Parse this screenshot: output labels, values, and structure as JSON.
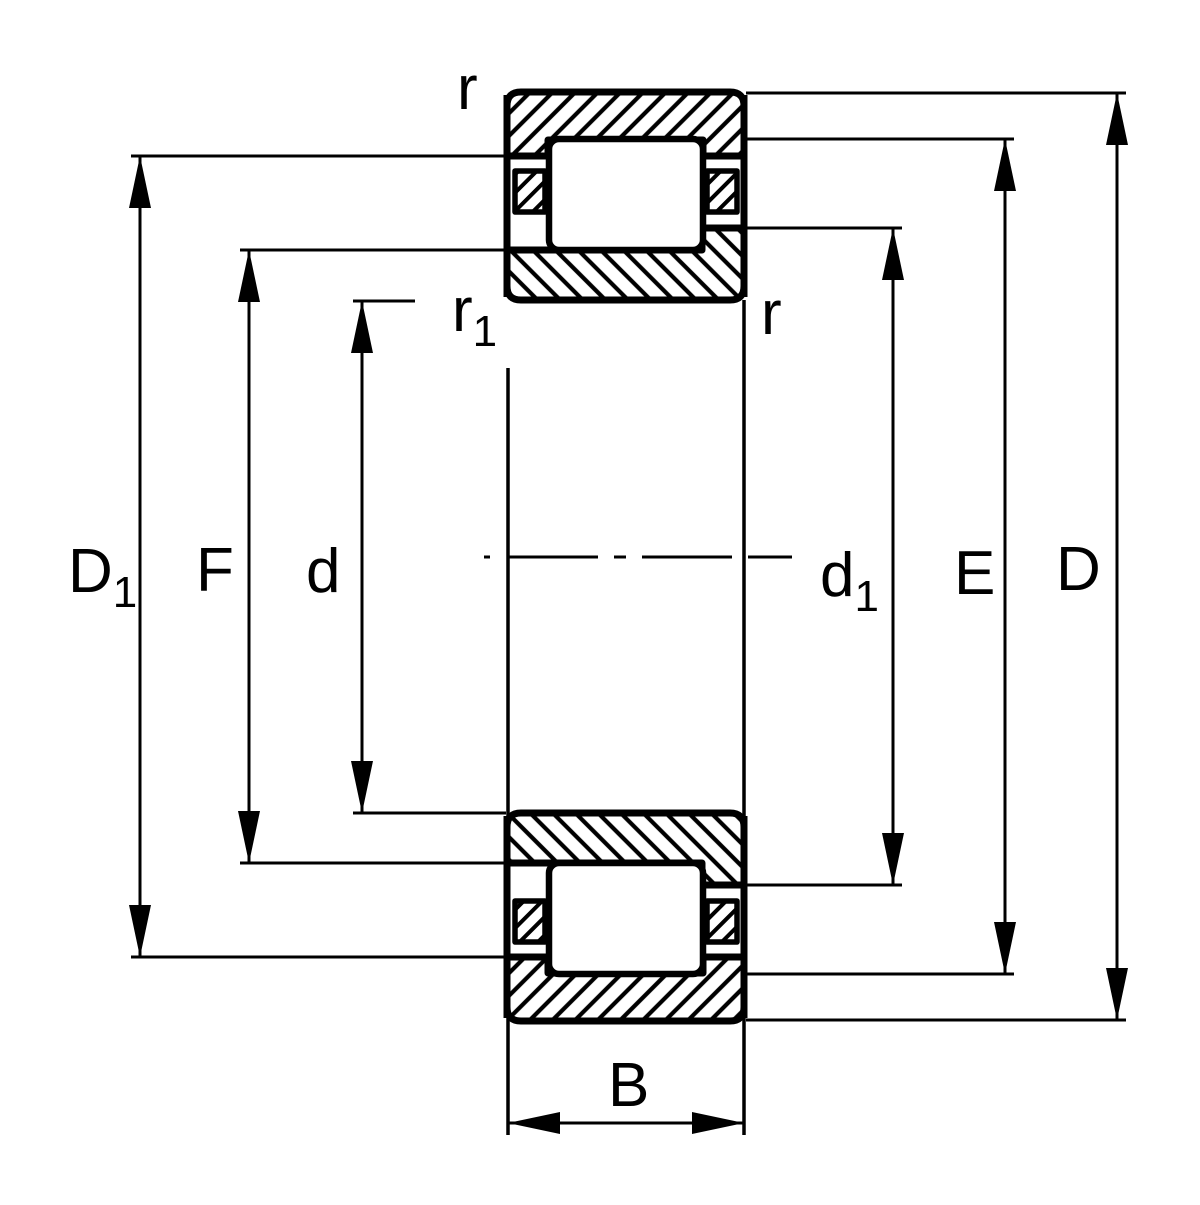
{
  "colors": {
    "line": "#000000",
    "background": "#ffffff"
  },
  "dimension_labels": {
    "D1": {
      "main": "D",
      "sub": "1"
    },
    "F": {
      "main": "F",
      "sub": ""
    },
    "d": {
      "main": "d",
      "sub": ""
    },
    "d1": {
      "main": "d",
      "sub": "1"
    },
    "E": {
      "main": "E",
      "sub": ""
    },
    "D": {
      "main": "D",
      "sub": ""
    },
    "B": {
      "main": "B",
      "sub": ""
    }
  },
  "chamfer_labels": {
    "r_top": {
      "main": "r",
      "sub": ""
    },
    "r_inner": {
      "main": "r",
      "sub": "1"
    },
    "r_right": {
      "main": "r",
      "sub": ""
    }
  }
}
